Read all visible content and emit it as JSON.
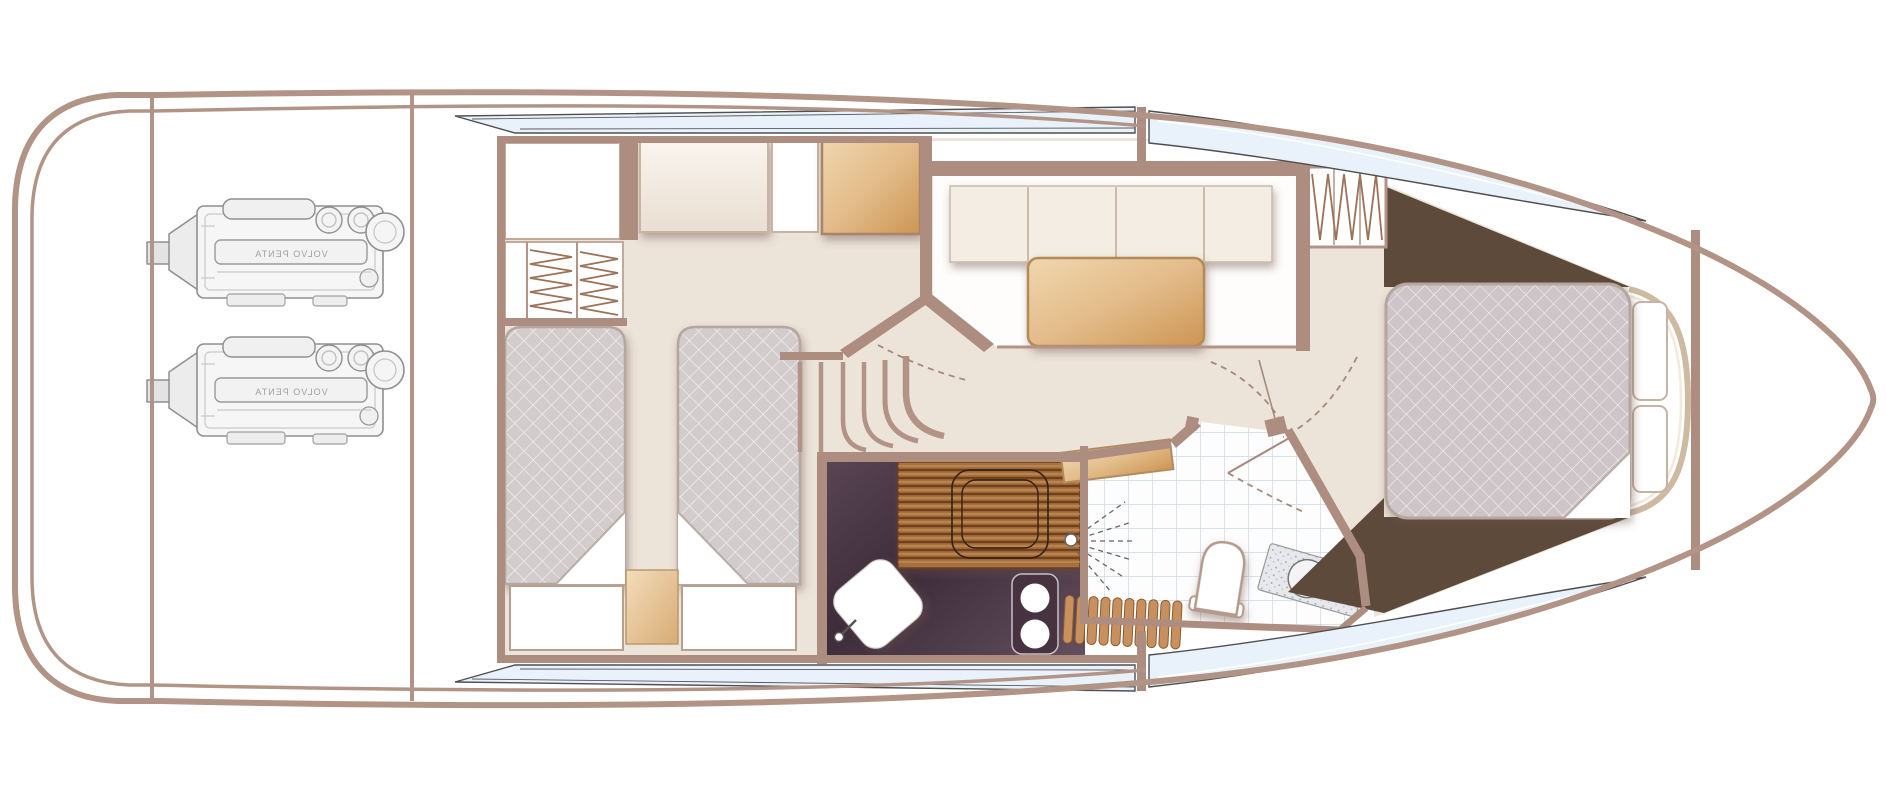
{
  "plan": {
    "engine_label": "VOLVO PENTA",
    "colors": {
      "hull": "#b29486",
      "wall": "#ad8d7f",
      "floor": "#ece3d9",
      "panel_cream": "#f5efe7",
      "dark_wood": "#5d4a3b",
      "galley_floor": "#43303f",
      "wood_light": "#d9a564",
      "mattress": "#d3cccd",
      "window_glass": "#e9f2fa",
      "tile_line": "#ccd7e3"
    },
    "regions": [
      "engine-room",
      "twin-guest-cabin",
      "wardrobe",
      "staircase",
      "salon-dinette",
      "galley",
      "bathroom",
      "master-cabin",
      "bow-deck"
    ]
  }
}
